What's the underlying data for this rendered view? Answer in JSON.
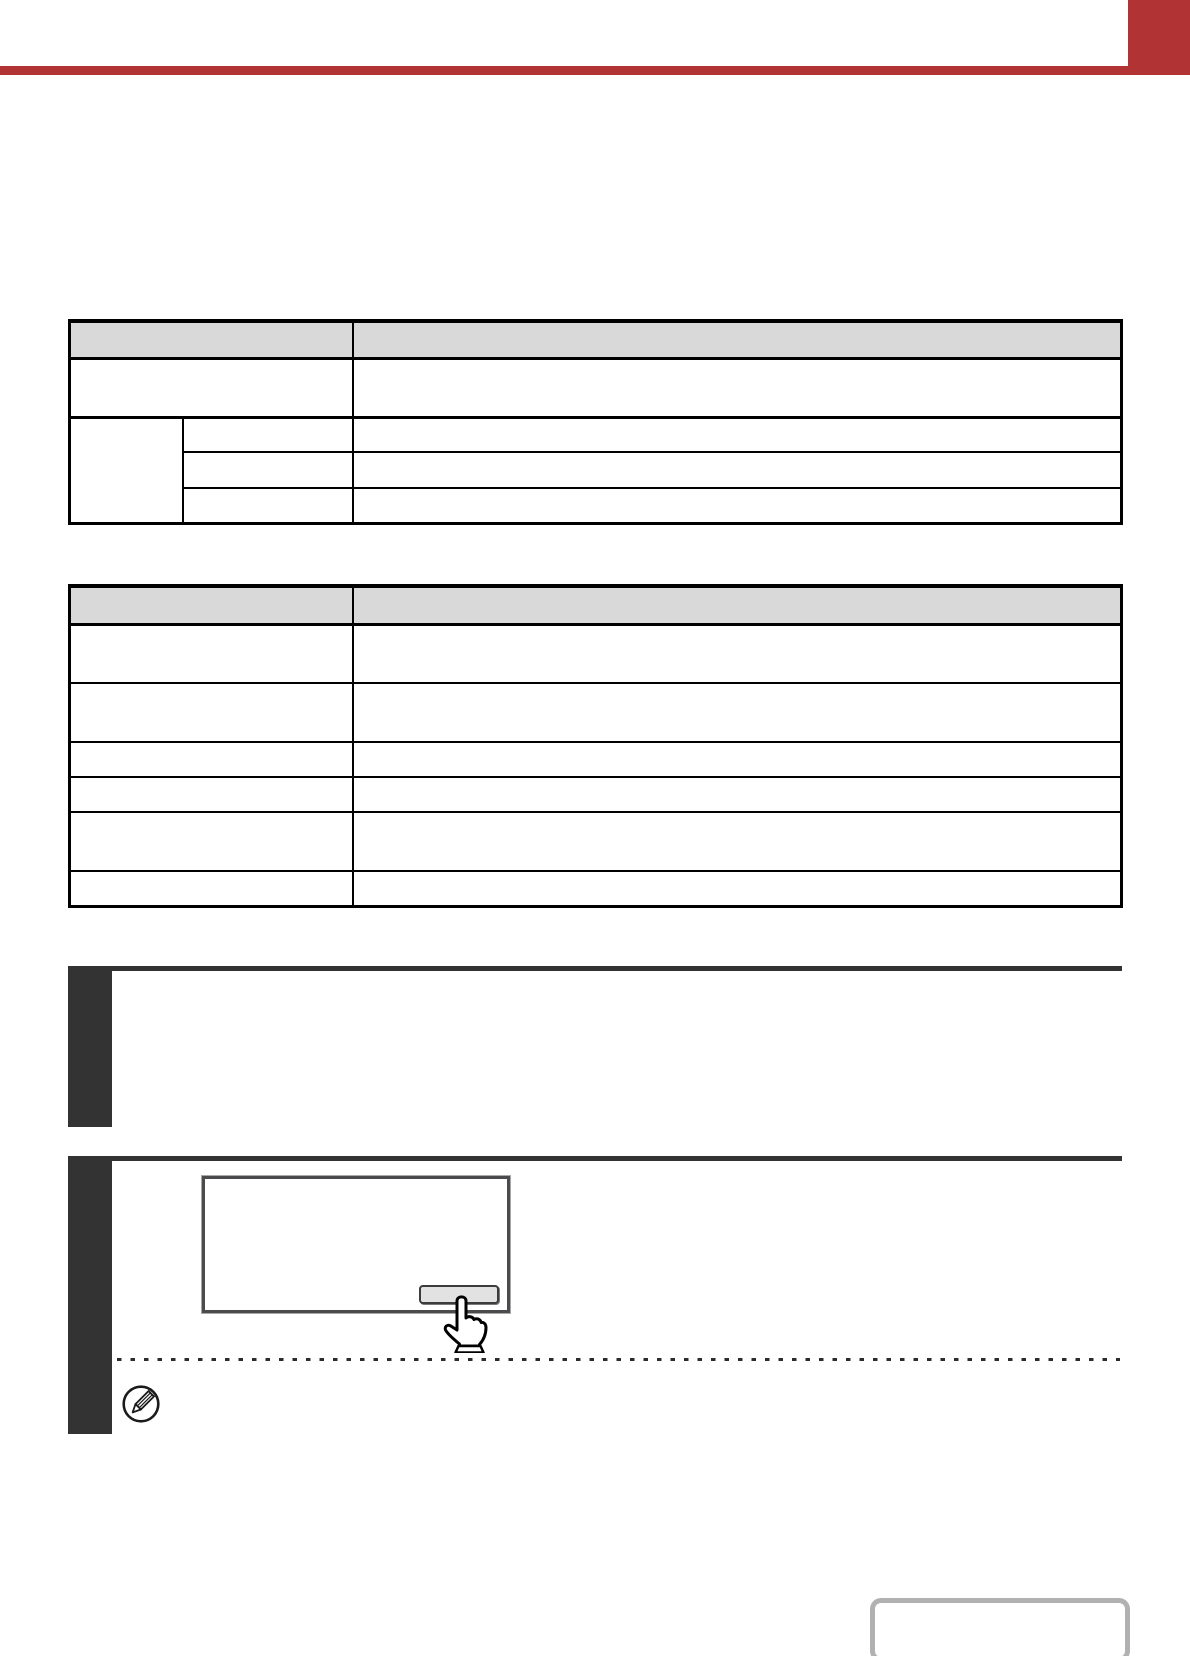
{
  "page": {
    "kind": "printer-manual-page",
    "background": "#ffffff",
    "note": ""
  },
  "header": {
    "accent_color": "#b23333",
    "chapter_title": "",
    "tab_label": ""
  },
  "colors": {
    "accent_red": "#b23333",
    "step_bar_dark": "#333333",
    "table_header_bg": "#d9d9d9",
    "table_border": "#000000",
    "panel_border": "#4b4b4e",
    "key_fill": "#e2e2e2",
    "nav_box_border": "#b1b1b1"
  },
  "table1": {
    "header": {
      "c1": "",
      "c2": ""
    },
    "row1": {
      "c1": "",
      "c2": ""
    },
    "group": {
      "label": ""
    },
    "sub1": {
      "c1": "",
      "c2": ""
    },
    "sub2": {
      "c1": "",
      "c2": ""
    },
    "sub3": {
      "c1": "",
      "c2": ""
    }
  },
  "table2": {
    "header": {
      "c1": "",
      "c2": ""
    },
    "rows": [
      {
        "c1": "",
        "c2": ""
      },
      {
        "c1": "",
        "c2": ""
      },
      {
        "c1": "",
        "c2": ""
      },
      {
        "c1": "",
        "c2": ""
      },
      {
        "c1": "",
        "c2": ""
      },
      {
        "c1": "",
        "c2": ""
      }
    ]
  },
  "steps": [
    {
      "number": "",
      "text": ""
    },
    {
      "number": "",
      "text": ""
    }
  ],
  "illustration": {
    "key_label": "",
    "screen_text": ""
  },
  "note": {
    "text": ""
  },
  "icons": {
    "hand": "hand-pointer-icon",
    "note": "pencil-note-icon"
  },
  "page_nav": {
    "label": ""
  }
}
